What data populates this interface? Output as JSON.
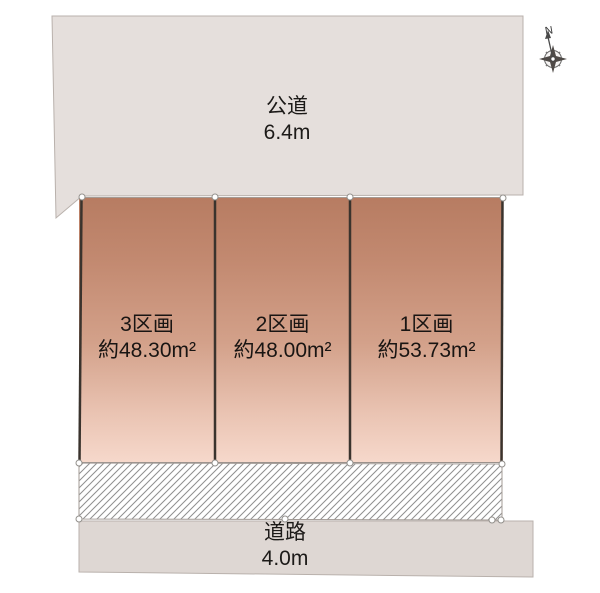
{
  "diagram": {
    "title_hint": "land-parcel-layout",
    "compass": {
      "north_label": "N"
    },
    "public_road": {
      "label": "公道",
      "width": "6.4m"
    },
    "front_road": {
      "label": "道路",
      "width": "4.0m"
    },
    "lots": [
      {
        "label": "3区画",
        "area": "約48.30m²"
      },
      {
        "label": "2区画",
        "area": "約48.00m²"
      },
      {
        "label": "1区画",
        "area": "約53.73m²"
      }
    ],
    "colors": {
      "road_fill_top": "#e5dfdc",
      "road_fill_bottom": "#ded7d3",
      "lot_gradient_top": "#b77c62",
      "lot_gradient_bottom": "#f6d8cb",
      "boundary_line": "#3a332d",
      "hatch_line": "#8f8f8f",
      "outline": "#b5aca7"
    }
  }
}
